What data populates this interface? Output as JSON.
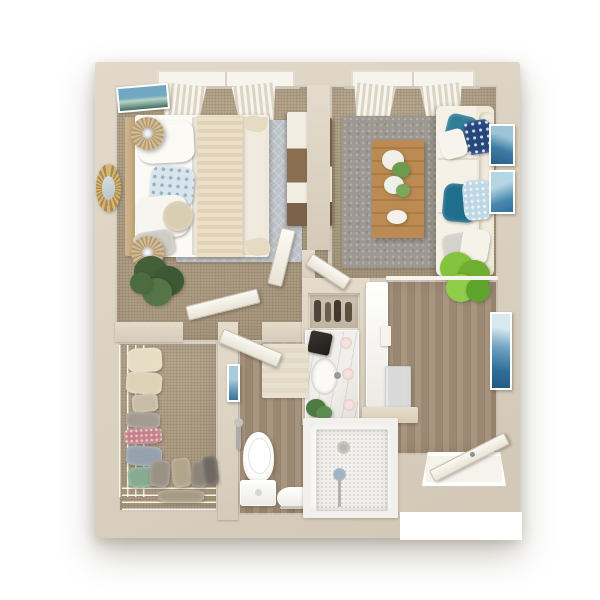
{
  "scene": {
    "title": "apartment-3d-floor-plan-top-view",
    "background_color": "#ffffff",
    "style": "photorealistic 3D dollhouse render, one-bedroom apartment"
  },
  "palette": {
    "wall": "#dcd2c2",
    "carpet": "#b2a187",
    "wood_floor": "#a3907a",
    "bedroom_rug": "#bdc3c9",
    "living_rug": "#9d9992",
    "sofa_cream": "#f4efe5",
    "accent_teal": "#2f7e96",
    "accent_navy": "#24477d",
    "accent_light_blue": "#bdd8e4",
    "plant_dark_green": "#4c6b41",
    "plant_bright_green": "#84c33e",
    "coffee_table_wood": "#b5854f",
    "gold_mirror": "#c3a269",
    "white_fixture": "#ffffff"
  },
  "rooms": [
    {
      "id": "bedroom",
      "label": "Bedroom",
      "floor": "carpet",
      "items": [
        "window with tied white curtains",
        "framed coastal wall art",
        "bed with white bedding and knit throw",
        "blue floral accent pillow",
        "two rattan drum nightstands with silver lamps",
        "gold sunburst round mirror",
        "light blue-gray area rug",
        "dark green potted plant",
        "wood dresser with white drawers",
        "open white door"
      ]
    },
    {
      "id": "living-room",
      "label": "Living room",
      "floor": "carpet",
      "items": [
        "window with tied white curtains",
        "dark wood media console",
        "gray textured area rug",
        "wood coffee table with white flowers",
        "cream sofa with teal, navy and light-blue pillows",
        "two framed blue artworks",
        "bright green potted plant",
        "open white door"
      ]
    },
    {
      "id": "closet",
      "label": "Walk-in closet",
      "floor": "carpet",
      "items": [
        "wire shelving with hanging clothes in cream, gray, pink, blue and green",
        "bottom wire shoe and boot shelf"
      ]
    },
    {
      "id": "bathroom",
      "label": "Bathroom",
      "floor": "wood",
      "items": [
        "white toilet",
        "beige bath mat",
        "small framed artwork",
        "wall shower fixture",
        "white step stool",
        "wood towel ladder",
        "open white door"
      ]
    },
    {
      "id": "shower-room",
      "label": "Walk-in shower",
      "floor": "penny tile",
      "items": [
        "white tiled shower pan",
        "floor drain",
        "handheld shower wand"
      ]
    },
    {
      "id": "vanity-nook",
      "label": "Vanity kitchenette nook",
      "floor": "wood",
      "items": [
        "display shelf with dark bottles",
        "marble counter",
        "black coffee maker",
        "oval white sink with faucet",
        "three pink glasses",
        "small green plant",
        "tall white cabinet",
        "frosted glass panel",
        "beige bench ledge",
        "light switch"
      ]
    },
    {
      "id": "entry-hall",
      "label": "Entry hall",
      "floor": "wood",
      "items": [
        "tall blue framed artwork",
        "open white entry door with threshold"
      ]
    }
  ]
}
